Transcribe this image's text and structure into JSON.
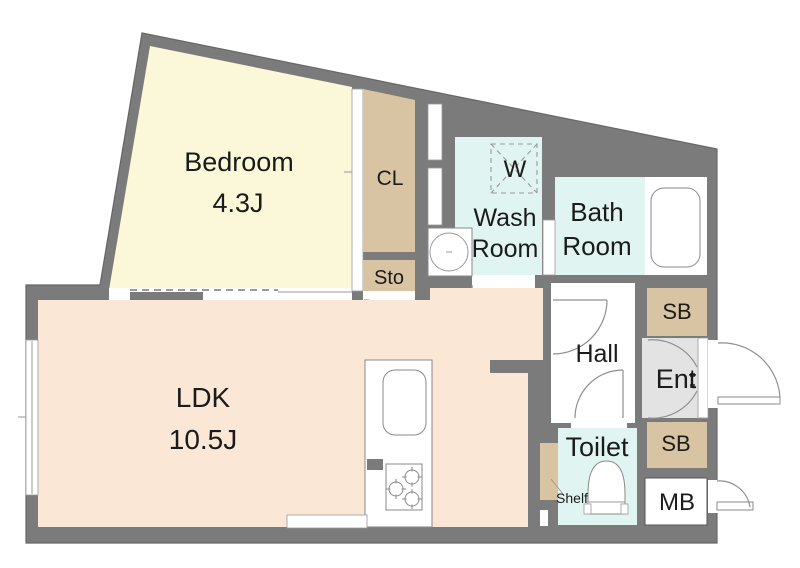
{
  "rooms": {
    "bedroom": {
      "label": "Bedroom",
      "size": "4.3J"
    },
    "ldk": {
      "label": "LDK",
      "size": "10.5J"
    },
    "wash_room": {
      "label_line1": "Wash",
      "label_line2": "Room"
    },
    "bath_room": {
      "label_line1": "Bath",
      "label_line2": "Room"
    },
    "hall": {
      "label": "Hall"
    },
    "entrance": {
      "label": "Ent"
    },
    "toilet": {
      "label": "Toilet"
    }
  },
  "fixtures": {
    "closet": {
      "label": "CL"
    },
    "storage": {
      "label": "Sto"
    },
    "washer": {
      "label": "W"
    },
    "shoe_box_upper": {
      "label": "SB"
    },
    "shoe_box_lower": {
      "label": "SB"
    },
    "meter_box": {
      "label": "MB"
    },
    "shelf": {
      "label": "Shelf"
    }
  },
  "colors": {
    "wall": "#7b7b7b",
    "bedroom": "#faf8d8",
    "ldk": "#fae7d5",
    "wet": "#e0f4f1",
    "storage": "#d8c4a3",
    "entrance": "#e3e3e3"
  }
}
